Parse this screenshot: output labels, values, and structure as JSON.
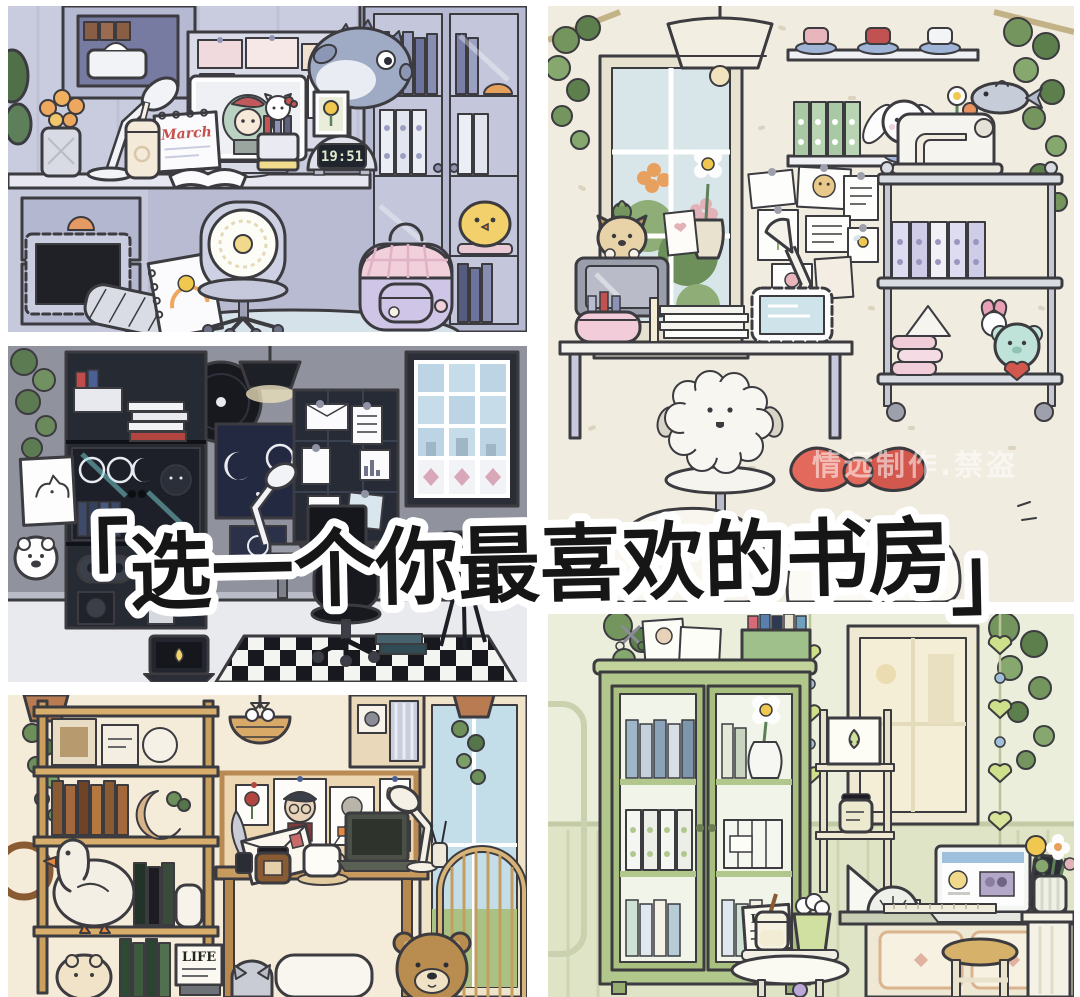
{
  "page": {
    "type": "image-collage",
    "language": "zh-CN",
    "background": "#ffffff"
  },
  "overlay": {
    "bracket_open": "「",
    "text": "选一个你最喜欢的书房",
    "bracket_close": "」",
    "full_title": "「选一个你最喜欢的书房」",
    "text_color": "#161616",
    "outline_color": "#ffffff"
  },
  "watermark": {
    "text": "情远制作.禁盗",
    "color": "rgba(255,255,255,0.55)"
  },
  "panels": {
    "lavender_study": {
      "title": "lavender study room",
      "position": "top-left",
      "clock_time": "19:51",
      "calendar_month": "March",
      "wall_color": "#c9cbde",
      "items": [
        "desk with drawers and orange handle",
        "white desk lamp",
        "orange tulips in vase",
        "cream tumbler with straw",
        "monitor showing girl avatar with red beret and green hair",
        "March desk calendar",
        "open notebook",
        "Hello Kitty pen cup with markers",
        "dome digital clock showing 19:51",
        "framed yellow flower print",
        "moodboard with pink cards",
        "hanging pufferfish plush",
        "glass-door bookcase with books, binders and yellow chick plush",
        "office chair with crochet doily cover",
        "lilac backpack with pink gingham flap",
        "spiral sketchbook with rainbow doodle",
        "black picture frame",
        "striped pillow",
        "light blue rug"
      ]
    },
    "dark_studio": {
      "title": "dark gamer study",
      "position": "middle-left",
      "wall_color": "#90939d",
      "items": [
        "black shelf unit with white book stacks, pen caddy, vinyl record, game cases, controller, camera and speaker",
        "moon phase posters with stars",
        "black pendant lamp",
        "black grid moodboard with notes, envelope and chart card",
        "desk with dark laptop, mug and white lamp",
        "black office chair",
        "black and white checkered rug",
        "laptop on floor with yellow chick wallpaper",
        "camera on tripod",
        "stained glass window with pink diamonds",
        "dog sketch poster",
        "polar bear card",
        "ivy plant",
        "stacked teal books"
      ]
    },
    "wood_study": {
      "title": "warm wooden study",
      "position": "bottom-left",
      "life_label": "LIFE",
      "wall_color": "#f5ebd9",
      "items": [
        "wooden ladder shelf with picture frames, brown books, moon planter, goose plush, dark books and white vase",
        "hanging woven basket with white bow and cat",
        "wall cabinet with instax camera and striped curtain",
        "cork moodboard with artist portrait, rose card, butterfly and sketches",
        "wooden desk with stamped envelope, quill, ink pot, candle jar, tea mug, laptop and white lamp",
        "reed diffuser",
        "rattan arch chair",
        "window with blue sky",
        "hanging ivy in terracotta pots",
        "green books and LIFE magazine",
        "grey cat peeking behind books",
        "brown bear plush",
        "hamster plush",
        "white floor cushion",
        "round wooden wall frame"
      ]
    },
    "cream_craft_room": {
      "title": "cream craft study",
      "position": "top-right",
      "wall_color": "#f1ece0",
      "items": [
        "cream pendant dome lamp",
        "window with greenery and orange hydrangeas",
        "wall shelf with teacup and saucer sets",
        "green ring binders",
        "Cinnamoroll plush sitting in blue bowl",
        "flower crate with daisy and tulip",
        "white sewing machine with grey fish ornament",
        "metal cart with lavender binders, pink paper rolls, mint bear holding red heart and My Melody",
        "note collage wall with white desk lamp",
        "shiba puppy figure with cactus sprout sitting on grey TV",
        "daisy bud vase and heart card",
        "white desk with pink pencil pouch, ruler, paper stack and tablet in scalloped frame",
        "fluffy white sheep desk chair with star base",
        "red bow pillow and white floor cushions",
        "hanging plants on bamboo poles"
      ]
    },
    "green_study": {
      "title": "sage green study",
      "position": "bottom-right",
      "menu_label": "LIFE",
      "wall_color": "#e4e8d2",
      "items": [
        "green glass-door display cabinet with blue books, white ring binders, daisy pear vase, milk crate and pastel books",
        "photo cards, scissors and green book box on cabinet top",
        "green heart garlands with blue beads",
        "cream ladder shelf with pear character print and candle jar",
        "warm glowing window",
        "green desk with white laptop showing browser, black phone, potted cactus, set square, protractor and ruler",
        "cream cabinet with diamond inlay panels",
        "round wooden stool",
        "white side table with LIFE menu card, milk jar with straw and matcha frappe",
        "fluted pedestal with striped vase of yellow, white and pink flowers",
        "hanging plants in both corners"
      ]
    }
  }
}
